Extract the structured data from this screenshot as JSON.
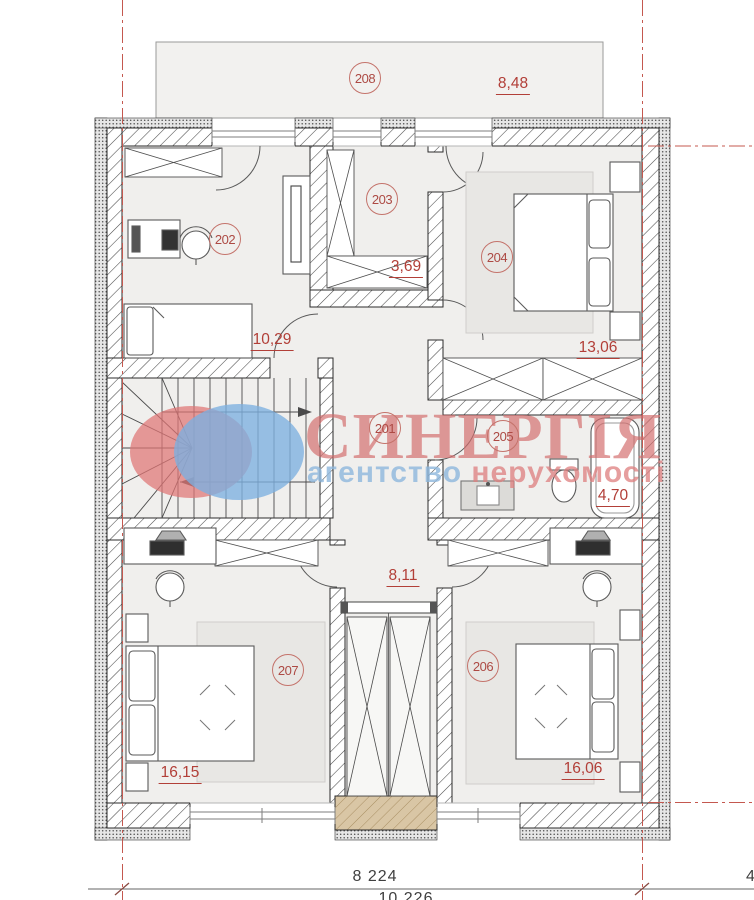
{
  "watermark": {
    "brand": "СИНЕРГІЯ",
    "tagline_word1": "агентство",
    "tagline_word2": "нерухомості"
  },
  "rooms": {
    "r201": {
      "number": "201",
      "area": "8,11"
    },
    "r202": {
      "number": "202",
      "area": "10,29"
    },
    "r203": {
      "number": "203",
      "area": "3,69"
    },
    "r204": {
      "number": "204",
      "area": "13,06"
    },
    "r205": {
      "number": "205",
      "area": "4,70"
    },
    "r206": {
      "number": "206",
      "area": "16,06"
    },
    "r207": {
      "number": "207",
      "area": "16,15"
    },
    "r208": {
      "number": "208",
      "area": "8,48"
    }
  },
  "dimensions": {
    "width_main": "8 224",
    "width_secondary": "10 226",
    "right_partial": "4"
  },
  "colors": {
    "accent_red": "#b23f38",
    "axis_red": "#c4584f",
    "wall_dark": "#2b2b2b",
    "floor": "#f0efed",
    "rug": "#e8e7e4",
    "chimney_tan": "#d9c6a5",
    "watermark_pink": "#d36b6b",
    "watermark_blue": "#8db7dc"
  }
}
